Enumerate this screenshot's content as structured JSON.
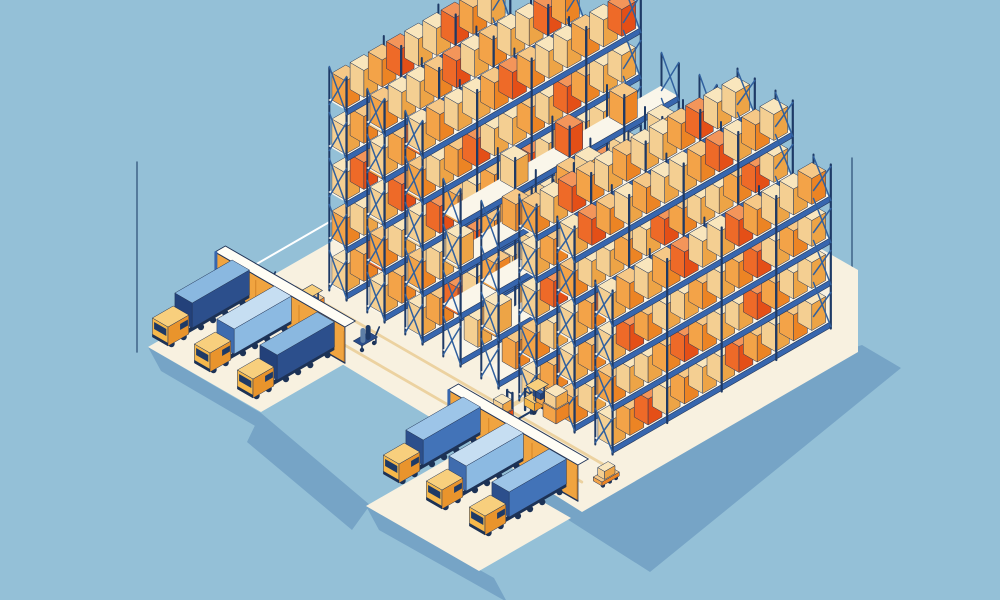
{
  "palette": {
    "bg": "#94c0d7",
    "shadow": "#76a4c6",
    "floor": "#f8f1e0",
    "lane": "#ecd2a0",
    "rail": "#3766ae",
    "plank": "#faf6ea",
    "post": "#1e3a66",
    "brace": "#31619f",
    "outline": "#223558",
    "corner_line": "#44688c",
    "wall_top": "#fffdf5",
    "door": "#f0a440",
    "door_jamb": "#d98a2b",
    "glass": "#1e3a66",
    "wheel": "#1c3256",
    "truck_front": "#f6b84a",
    "truck_side": "#e9942c",
    "truck_top": "#f8cf7d",
    "rim": "#ffffff",
    "navy_load": [
      "#2a4d8a",
      "#223f73",
      "#3e6db5"
    ],
    "box": {
      "T": [
        "#f4cf92",
        "#eda446",
        "#f9e6bd"
      ],
      "O": [
        "#f3a348",
        "#ec8424",
        "#f6c887"
      ],
      "R": [
        "#ee6a28",
        "#e44f17",
        "#f3955a"
      ]
    },
    "trailer": {
      "navy": {
        "side": "#2c4f8c",
        "front": "#23417a",
        "top": "#8ab8e0"
      },
      "light": {
        "side": "#8cbae2",
        "front": "#3f6cae",
        "top": "#c6def2"
      },
      "steel": {
        "side": "#4273b8",
        "front": "#2c4f8c",
        "top": "#9dc5e8"
      }
    }
  },
  "scene": {
    "corner_lines": [
      {
        "x": 137,
        "y1": 162,
        "y2": 352
      },
      {
        "x": 852,
        "y1": 158,
        "y2": 350
      }
    ],
    "shadows": [
      {
        "name": "shadow-main",
        "points": [
          [
            545,
            448
          ],
          [
            862,
            345
          ],
          [
            901,
            368
          ],
          [
            650,
            572
          ],
          [
            545,
            505
          ]
        ]
      },
      {
        "name": "shadow-left-dock",
        "points": [
          [
            148,
            347
          ],
          [
            261,
            413
          ],
          [
            274,
            437
          ],
          [
            161,
            371
          ]
        ]
      },
      {
        "name": "shadow-road",
        "points": [
          [
            261,
            413
          ],
          [
            370,
            505
          ],
          [
            352,
            530
          ],
          [
            247,
            442
          ]
        ]
      },
      {
        "name": "shadow-bottom-dock",
        "points": [
          [
            366,
            506
          ],
          [
            494,
            578
          ],
          [
            507,
            602
          ],
          [
            379,
            530
          ]
        ]
      }
    ],
    "floor": {
      "main": [
        [
          212,
          310
        ],
        [
          570,
          105
        ],
        [
          858,
          270
        ],
        [
          858,
          352
        ],
        [
          582,
          512
        ],
        [
          448,
          428
        ],
        [
          332,
          358
        ],
        [
          215,
          288
        ]
      ],
      "apron_left": [
        [
          148,
          347
        ],
        [
          240,
          294
        ],
        [
          353,
          359
        ],
        [
          261,
          412
        ]
      ],
      "apron_bottom": [
        [
          366,
          506
        ],
        [
          458,
          453
        ],
        [
          571,
          518
        ],
        [
          479,
          571
        ]
      ],
      "rim": [
        [
          215,
          288
        ],
        [
          475,
          138
        ]
      ]
    },
    "lanes": [
      {
        "x": 270,
        "y": 302,
        "dir": "u",
        "len": 360
      },
      {
        "x": 296,
        "y": 287,
        "dir": "u",
        "len": 360
      },
      {
        "x": 380,
        "y": 298,
        "dir": "v",
        "len": 250
      },
      {
        "x": 452,
        "y": 441,
        "dir": "v",
        "len": 290
      },
      {
        "x": 468,
        "y": 430,
        "dir": "v",
        "len": 300
      }
    ],
    "racks": [
      {
        "x": 344,
        "y": 299,
        "bays": 9,
        "levels": 5,
        "lh": 46,
        "bh": 27,
        "pattern": [
          "TORTOTTRO",
          "OTTROTOTT",
          "TROTTOTOR",
          "TOTORETTO",
          "OTORTTROT"
        ]
      },
      {
        "x": 382,
        "y": 321,
        "bays": 11,
        "levels": 5,
        "lh": 46,
        "bh": 27,
        "pattern": [
          "TOTRTOTTORT",
          "OTTOROTROTT",
          "TROTTOTORTO",
          "TOROTETRTOT",
          "OTTORTOTTRO"
        ]
      },
      {
        "x": 420,
        "y": 343,
        "bays": 12,
        "levels": 5,
        "lh": 46,
        "bh": 27,
        "pattern": [
          "TORTOTTROTOT",
          "OTTROTOTTORT",
          "TROTOTRTOTTO",
          "OTORTTOTROTT",
          "TOTTOROTTOTR"
        ]
      },
      {
        "x": 458,
        "y": 365,
        "bays": 12,
        "levels": 4,
        "lh": 46,
        "bh": 27,
        "pattern": [
          "ETOEOTEETEOE",
          "EEOETTEEOREE",
          "TEEOEEOEETEE",
          "EEETEEREEOEE"
        ]
      },
      {
        "x": 496,
        "y": 387,
        "bays": 12,
        "levels": 4,
        "lh": 46,
        "bh": 27,
        "pattern": [
          "EOETEEOTEEET",
          "TEEOEETEEOEE",
          "EETEEOETEEOE",
          "EOEEOTEEETEE"
        ]
      },
      {
        "x": 534,
        "y": 409,
        "bays": 12,
        "levels": 5,
        "lh": 42,
        "bh": 26,
        "pattern": [
          "TORTOTTOTROT",
          "OTTOROTTROTO",
          "TROTTOTORTOT",
          "TOTORTTROTOT",
          "OTROTOTTORTT"
        ]
      },
      {
        "x": 572,
        "y": 431,
        "bays": 12,
        "levels": 5,
        "lh": 42,
        "bh": 26,
        "pattern": [
          "OTORTTOTROTT",
          "TOTROTORTTOT",
          "TORTOTTOROTT",
          "OTTOTROTTORT",
          "TROTOTTORTOT"
        ]
      },
      {
        "x": 610,
        "y": 453,
        "bays": 12,
        "levels": 4,
        "lh": 42,
        "bh": 26,
        "pattern": [
          "TORTOTTROTOT",
          "OTTOROTTROTT",
          "TROTTOTORTOT",
          "TOTORTTROTTO"
        ]
      }
    ],
    "walls": [
      {
        "x": 215,
        "y": 288,
        "len": 150,
        "h": 36,
        "doors": [
          [
            13,
            47
          ],
          [
            63,
            97
          ],
          [
            115,
            149
          ]
        ]
      },
      {
        "x": 448,
        "y": 426,
        "len": 150,
        "h": 36,
        "doors": [
          [
            13,
            47
          ],
          [
            63,
            97
          ],
          [
            115,
            149
          ]
        ]
      }
    ],
    "trucks": [
      {
        "x": 168,
        "y": 348,
        "variant": "navy"
      },
      {
        "x": 210,
        "y": 374,
        "variant": "light"
      },
      {
        "x": 253,
        "y": 400,
        "variant": "navy"
      },
      {
        "x": 399,
        "y": 485,
        "variant": "steel"
      },
      {
        "x": 442,
        "y": 511,
        "variant": "light"
      },
      {
        "x": 485,
        "y": 537,
        "variant": "steel"
      }
    ],
    "forklifts": [
      {
        "x": 306,
        "y": 322,
        "load": "navy"
      },
      {
        "x": 532,
        "y": 416,
        "load": "none"
      }
    ],
    "trolleys": [
      {
        "x": 258,
        "y": 297
      },
      {
        "x": 362,
        "y": 352
      }
    ],
    "stacker": {
      "x": 502,
      "y": 432
    },
    "dolly": {
      "x": 602,
      "y": 488
    },
    "box_stacks": [
      {
        "x": 556,
        "y": 424
      }
    ]
  }
}
